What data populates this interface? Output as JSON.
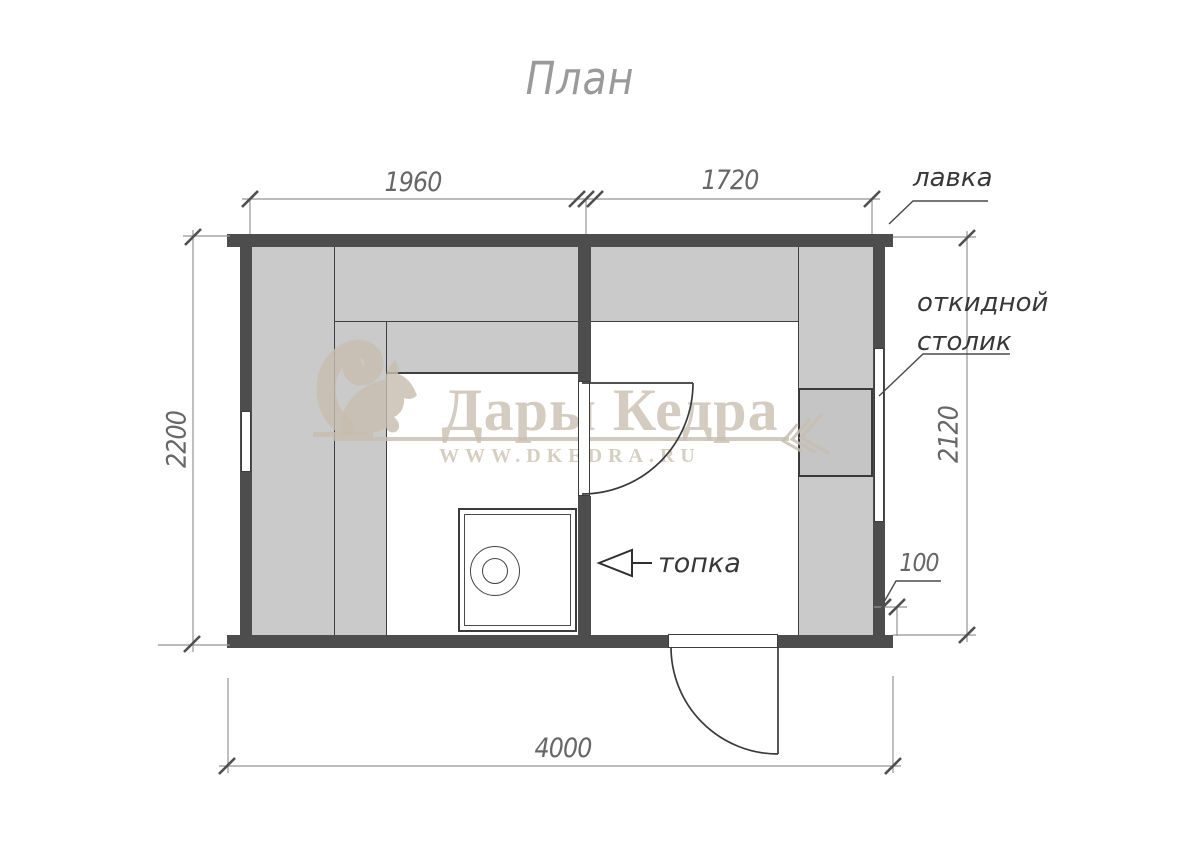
{
  "title": "План",
  "watermark": {
    "brand": "Дары Кедра",
    "site": "WWW.DKEDRA.RU",
    "squirrel_icon": "squirrel-logo",
    "branch_icon": "branch-ornament"
  },
  "dimensions": {
    "top_left": "1960",
    "top_right": "1720",
    "left_height": "2200",
    "right_height": "2120",
    "corner_offset": "100",
    "total_width": "4000"
  },
  "labels": {
    "bench": "лавка",
    "folding_table_line1": "откидной",
    "folding_table_line2": "столик",
    "firebox": "топка"
  },
  "colors": {
    "wall": "#4d4d4d",
    "bench": "#cacaca",
    "bench_dark": "#c5c5c5",
    "plan_line": "#3f3f3f",
    "dim_line": "#949494",
    "dim_text": "#676767",
    "label_text": "#383838",
    "title_text": "#9a9a9a",
    "watermark": "#c7bdaf"
  }
}
